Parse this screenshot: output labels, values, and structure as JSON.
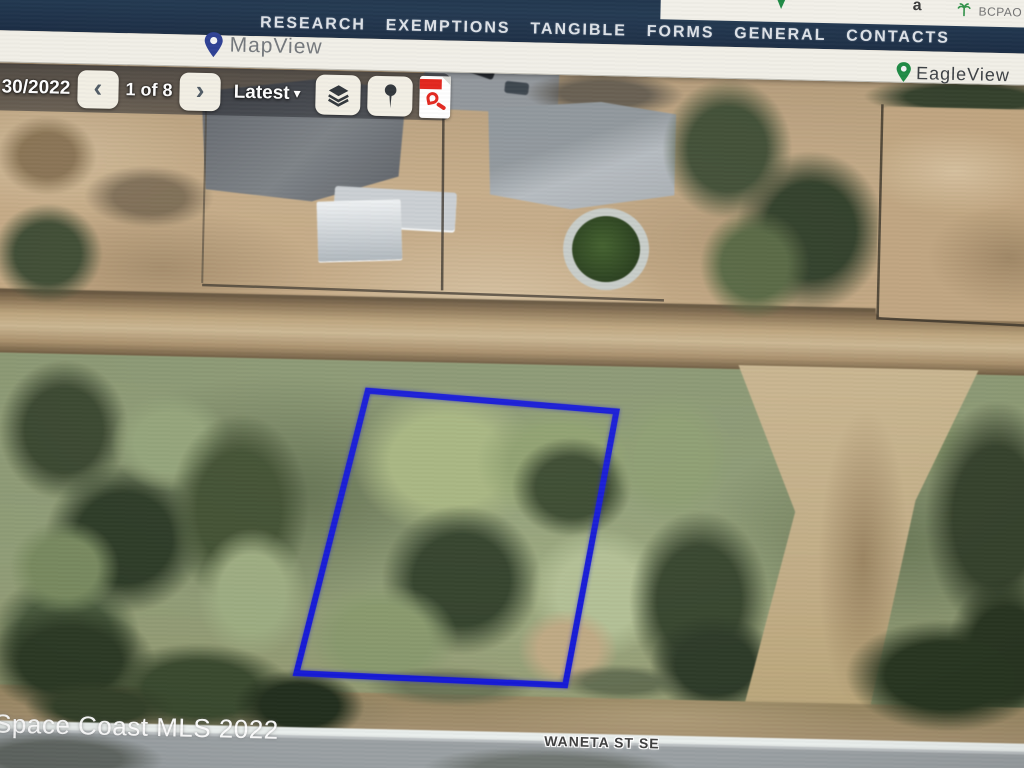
{
  "header": {
    "site_label": "BCPAO ...",
    "accessibility_label": "a"
  },
  "nav": {
    "items": [
      "RESEARCH",
      "EXEMPTIONS",
      "TANGIBLE",
      "FORMS",
      "GENERAL",
      "CONTACTS"
    ]
  },
  "toolbar": {
    "mapview_label": "MapView",
    "eagleview_label": "EagleView"
  },
  "map": {
    "controls": {
      "date": "30/2022",
      "prev_glyph": "‹",
      "counter": "1 of 8",
      "next_glyph": "›",
      "latest_label": "Latest",
      "caret_glyph": "▾"
    },
    "watermark": "Space Coast MLS 2022",
    "street_label": "WANETA ST SE"
  },
  "colors": {
    "nav-navy": "#223850",
    "bar-white": "#f1efe7",
    "parcel-blue": "#1418d6",
    "eagle-green": "#1e8a44",
    "mapview-pin": "#2c3e93",
    "pdf-red": "#e2231a"
  }
}
